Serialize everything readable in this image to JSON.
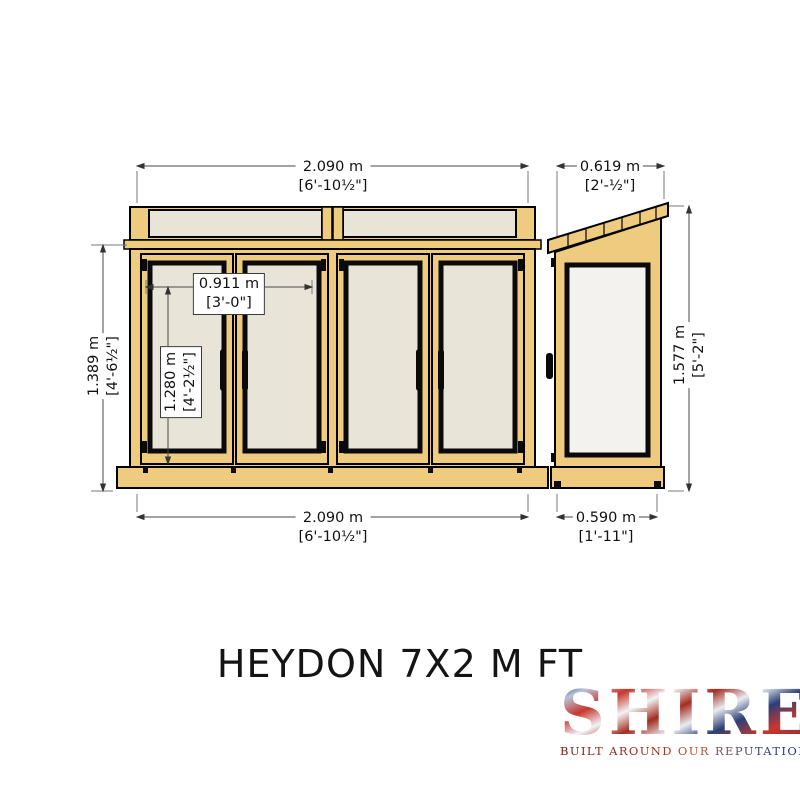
{
  "title": "HEYDON 7X2 M FT",
  "logo": {
    "brand": "SHIRE",
    "tagline": "BUILT AROUND OUR REPUTATION"
  },
  "dimensions": {
    "front_width_top": {
      "metric": "2.090 m",
      "imperial": "[6'-10½\"]"
    },
    "front_width_bottom": {
      "metric": "2.090 m",
      "imperial": "[6'-10½\"]"
    },
    "front_door_height_left": {
      "metric": "1.389 m",
      "imperial": "[4'-6½\"]"
    },
    "door_opening_width": {
      "metric": "0.911 m",
      "imperial": "[3'-0\"]"
    },
    "door_leaf_height": {
      "metric": "1.280 m",
      "imperial": "[4'-2½\"]"
    },
    "side_roof_width_top": {
      "metric": "0.619 m",
      "imperial": "[2'-½\"]"
    },
    "side_depth_bottom": {
      "metric": "0.590 m",
      "imperial": "[1'-11\"]"
    },
    "side_height_right": {
      "metric": "1.577 m",
      "imperial": "[5'-2\"]"
    }
  },
  "colors": {
    "wood": "#eecb7f",
    "glass": "#e8e4d7",
    "side_panel": "#f4f2ee",
    "dim_line": "#555555",
    "ink": "#111111"
  }
}
